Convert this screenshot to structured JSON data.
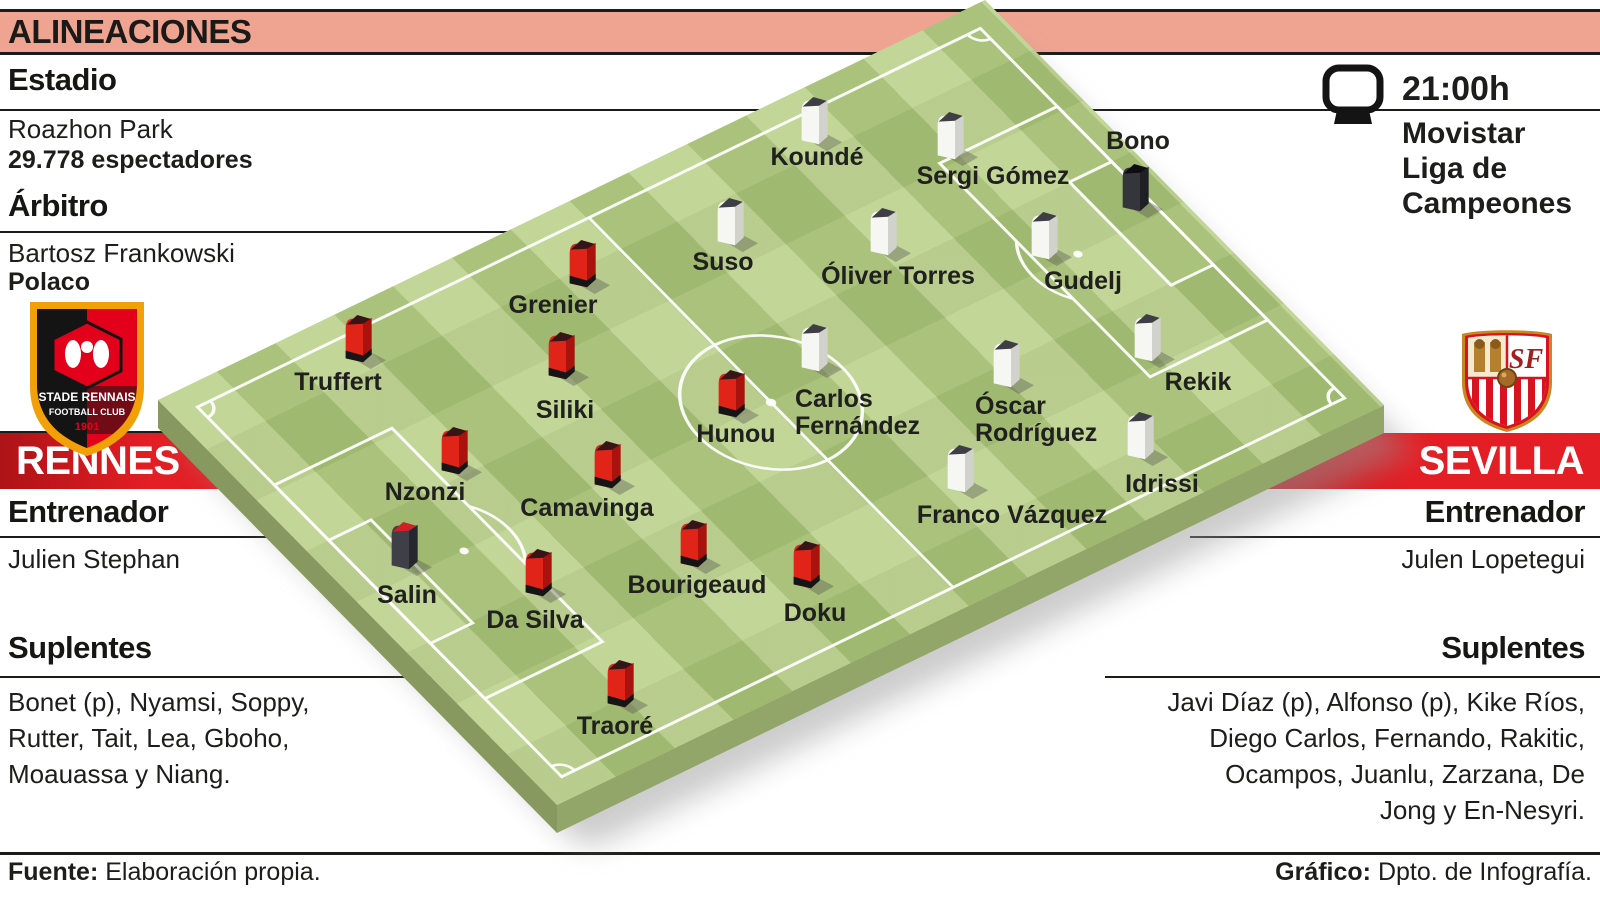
{
  "header": {
    "title": "ALINEACIONES"
  },
  "stadium": {
    "heading": "Estadio",
    "name": "Roazhon Park",
    "attendance": "29.778 espectadores"
  },
  "referee": {
    "heading": "Árbitro",
    "name": "Bartosz Frankowski",
    "nationality": "Polaco"
  },
  "broadcast": {
    "time": "21:00h",
    "channel": "Movistar\nLiga de\nCampeones",
    "icon": "tv-icon"
  },
  "home": {
    "name": "RENNES",
    "coach_heading": "Entrenador",
    "coach": "Julien Stephan",
    "subs_heading": "Suplentes",
    "subs": "Bonet (p), Nyamsi, Soppy,\nRutter, Tait, Lea, Gboho,\nMoauassa y Niang.",
    "crest": {
      "title": "STADE RENNAIS",
      "subtitle": "FOOTBALL CLUB",
      "year": "1901"
    }
  },
  "away": {
    "name": "SEVILLA",
    "coach_heading": "Entrenador",
    "coach": "Julen Lopetegui",
    "subs_heading": "Suplentes",
    "subs": "Javi Díaz (p), Alfonso (p), Kike Ríos,\nDiego Carlos, Fernando, Rakitic,\nOcampos, Juanlu, Zarzana, De\nJong y En-Nesyri.",
    "crest": {
      "monogram": "SF"
    }
  },
  "footer": {
    "source_label": "Fuente:",
    "source_text": " Elaboración propia.",
    "credit_label": "Gráfico:",
    "credit_text": " Dpto. de Infografía."
  },
  "colors": {
    "salmon": "#efa491",
    "banner_red": "#e31e24",
    "pitch_green": "#b2cb7d",
    "pitch_side_sw": "#87995f",
    "pitch_side_se": "#93a66a",
    "line_white": "rgba(255,255,255,0.92)",
    "home_kit": {
      "main": "#e02418",
      "side": "#a8130d",
      "cap": "#371418",
      "base": "#151515"
    },
    "home_gk_kit": {
      "main": "#3f3f48",
      "side": "#26262e",
      "cap": "#d01f26"
    },
    "away_kit": {
      "main": "#f6f6f2",
      "side": "#d2d2cc",
      "cap": "#3e3e44"
    },
    "away_gk_kit": {
      "main": "#35353c",
      "side": "#1f1f26",
      "cap": "#0e0e12"
    }
  },
  "pitch": {
    "players": {
      "home": [
        {
          "name": "Grenier",
          "fig": [
            561,
            236
          ],
          "label": {
            "x": 553,
            "y": 292,
            "align": "center",
            "text": "Grenier"
          }
        },
        {
          "name": "Truffert",
          "fig": [
            337,
            311
          ],
          "label": {
            "x": 338,
            "y": 369,
            "align": "center",
            "text": "Truffert"
          }
        },
        {
          "name": "Siliki",
          "fig": [
            540,
            328
          ],
          "label": {
            "x": 565,
            "y": 397,
            "align": "center",
            "text": "Siliki"
          }
        },
        {
          "name": "Hunou",
          "fig": [
            710,
            366
          ],
          "label": {
            "x": 736,
            "y": 421,
            "align": "center",
            "text": "Hunou"
          }
        },
        {
          "name": "Nzonzi",
          "fig": [
            433,
            423
          ],
          "label": {
            "x": 425,
            "y": 479,
            "align": "center",
            "text": "Nzonzi"
          }
        },
        {
          "name": "Camavinga",
          "fig": [
            586,
            437
          ],
          "label": {
            "x": 587,
            "y": 495,
            "align": "center",
            "text": "Camavinga"
          }
        },
        {
          "name": "Salin",
          "role": "gk",
          "fig": [
            383,
            518
          ],
          "label": {
            "x": 407,
            "y": 582,
            "align": "center",
            "text": "Salin"
          }
        },
        {
          "name": "Da Silva",
          "fig": [
            517,
            545
          ],
          "label": {
            "x": 535,
            "y": 607,
            "align": "center",
            "text": "Da Silva"
          }
        },
        {
          "name": "Bourigeaud",
          "fig": [
            672,
            516
          ],
          "label": {
            "x": 697,
            "y": 572,
            "align": "center",
            "text": "Bourigeaud"
          }
        },
        {
          "name": "Doku",
          "fig": [
            785,
            537
          ],
          "label": {
            "x": 815,
            "y": 600,
            "align": "center",
            "text": "Doku"
          }
        },
        {
          "name": "Traoré",
          "fig": [
            599,
            656
          ],
          "label": {
            "x": 615,
            "y": 713,
            "align": "center",
            "text": "Traoré"
          }
        }
      ],
      "away": [
        {
          "name": "Koundé",
          "fig": [
            793,
            93
          ],
          "label": {
            "x": 817,
            "y": 144,
            "align": "center",
            "text": "Koundé"
          }
        },
        {
          "name": "Sergi Gómez",
          "fig": [
            929,
            108
          ],
          "label": {
            "x": 993,
            "y": 163,
            "align": "center",
            "text": "Sergi Gómez"
          }
        },
        {
          "name": "Bono",
          "role": "gk",
          "fig": [
            1114,
            160
          ],
          "label": {
            "x": 1138,
            "y": 128,
            "align": "center",
            "text": "Bono"
          }
        },
        {
          "name": "Suso",
          "fig": [
            709,
            194
          ],
          "label": {
            "x": 723,
            "y": 249,
            "align": "center",
            "text": "Suso"
          }
        },
        {
          "name": "Óliver Torres",
          "fig": [
            862,
            204
          ],
          "label": {
            "x": 898,
            "y": 263,
            "align": "center",
            "text": "Óliver Torres"
          }
        },
        {
          "name": "Gudelj",
          "fig": [
            1023,
            208
          ],
          "label": {
            "x": 1083,
            "y": 268,
            "align": "center",
            "text": "Gudelj"
          }
        },
        {
          "name": "Rekik",
          "fig": [
            1126,
            310
          ],
          "label": {
            "x": 1198,
            "y": 369,
            "align": "center",
            "text": "Rekik"
          }
        },
        {
          "name": "Carlos Fernández",
          "fig": [
            793,
            320
          ],
          "label": {
            "x": 795,
            "y": 386,
            "align": "left",
            "text": "Carlos\nFernández"
          }
        },
        {
          "name": "Óscar Rodríguez",
          "fig": [
            985,
            336
          ],
          "label": {
            "x": 975,
            "y": 393,
            "align": "left",
            "text": "Óscar\nRodríguez"
          }
        },
        {
          "name": "Idrissi",
          "fig": [
            1119,
            408
          ],
          "label": {
            "x": 1162,
            "y": 471,
            "align": "center",
            "text": "Idrissi"
          }
        },
        {
          "name": "Franco Vázquez",
          "fig": [
            939,
            441
          ],
          "label": {
            "x": 1012,
            "y": 502,
            "align": "center",
            "text": "Franco Vázquez"
          }
        }
      ]
    }
  }
}
